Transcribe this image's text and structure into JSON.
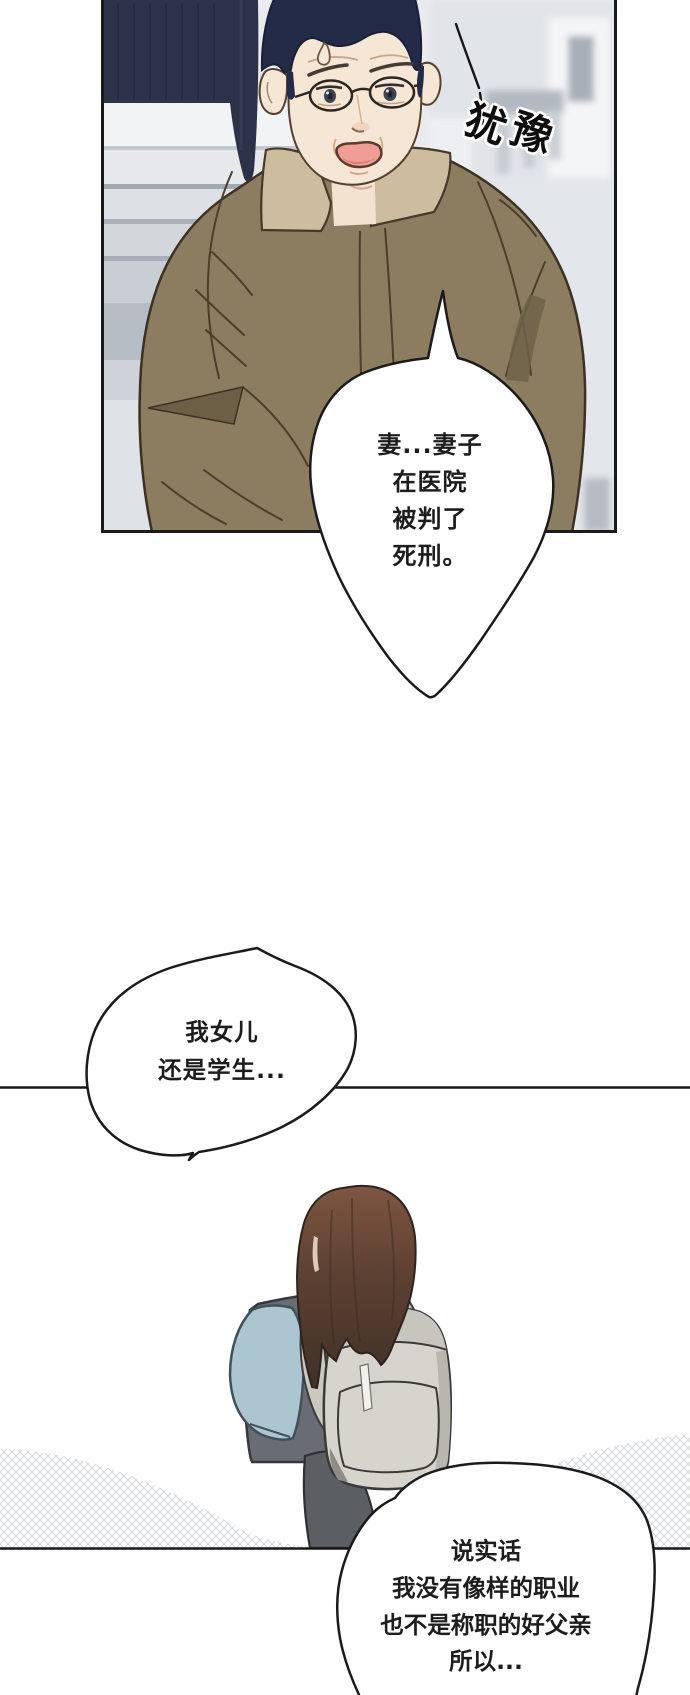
{
  "comic": {
    "sfx": {
      "text": "犹豫",
      "chars": [
        "犹",
        "豫"
      ]
    },
    "bubble1": {
      "lines": [
        "妻...妻子",
        "在医院",
        "被判了",
        "死刑。"
      ]
    },
    "bubble2": {
      "lines": [
        "我女儿",
        "还是学生..."
      ]
    },
    "bubble3": {
      "lines": [
        "说实话",
        "我没有像样的职业",
        "也不是称职的好父亲",
        "所以..."
      ]
    }
  },
  "colors": {
    "page_background": "#ffffff",
    "line_ink": "#1b1b1b",
    "panel1_background": "#e9ebee",
    "door_navy": "#2c3349",
    "man_hair": "#242b48",
    "skin": "#f6e6d6",
    "mouth_inner": "#f09d95",
    "jacket": "#8d7d60",
    "jacket_collar": "#cdbd9e",
    "girl_hair": "#7d5640",
    "girl_vest": "#696d73",
    "girl_sleeve": "#abc6d0",
    "girl_skirt": "#5b5e63",
    "backpack": "#d7d4ce"
  }
}
